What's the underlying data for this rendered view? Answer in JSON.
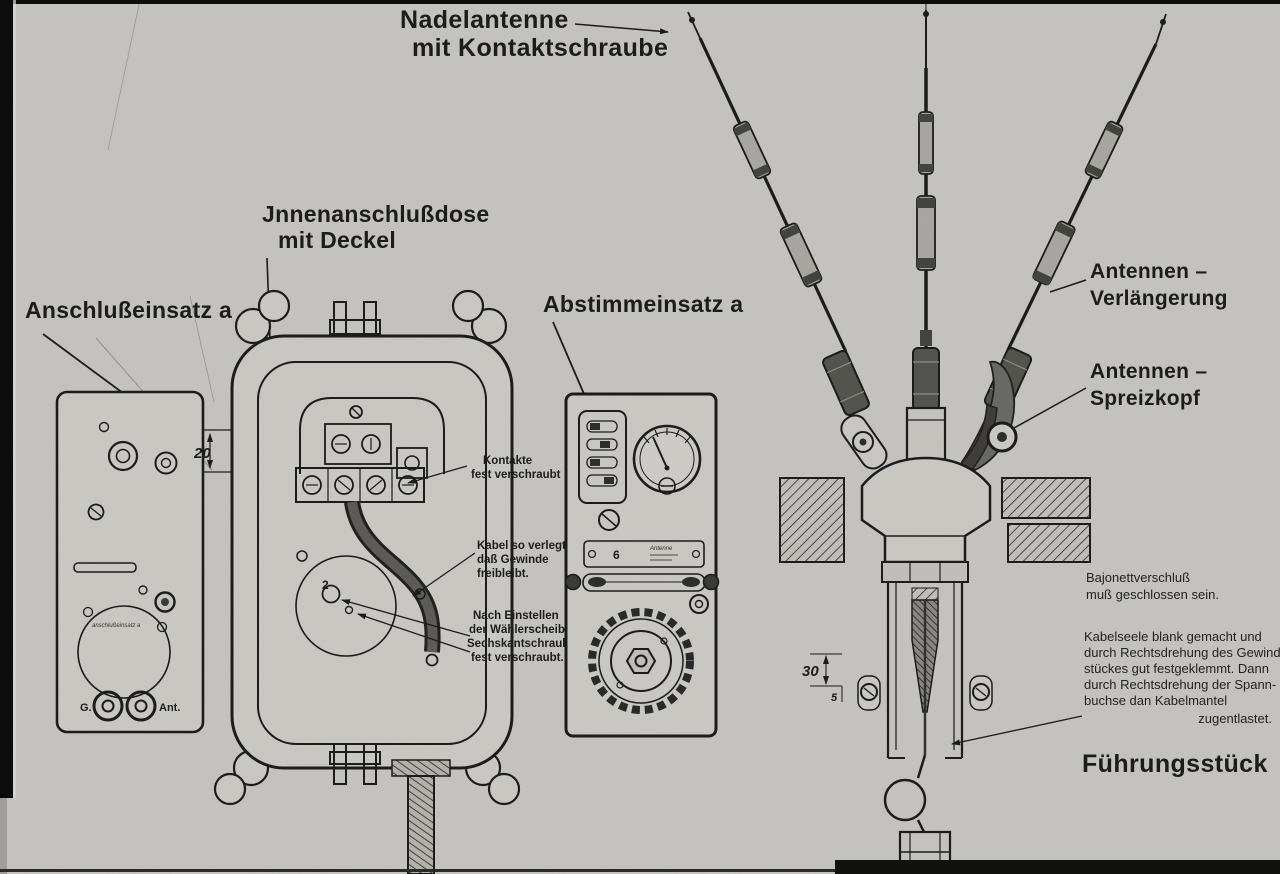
{
  "colors": {
    "paper": "#c6c5c1",
    "panel": "#cbcac5",
    "ink": "#1b1b1a",
    "dark_metal": "#55544f"
  },
  "callouts": {
    "nadelantenne": {
      "line1": "Nadelantenne",
      "line2": "mit Kontaktschraube"
    },
    "anschlusseinsatz": {
      "label": "Anschlußeinsatz a"
    },
    "innenanschlussdose": {
      "line1": "Jnnenanschlußdose",
      "line2": "mit Deckel"
    },
    "abstimmeinsatz": {
      "label": "Abstimmeinsatz a"
    },
    "antennen_verlaengerung": {
      "line1": "Antennen –",
      "line2": "Verlängerung"
    },
    "antennen_spreizkopf": {
      "line1": "Antennen –",
      "line2": "Spreizkopf"
    },
    "fuehrungsstueck": {
      "label": "Führungsstück"
    }
  },
  "annotations": {
    "kontakte": [
      "Kontakte",
      "fest verschraubt"
    ],
    "kabel": [
      "Kabel so verlegt,",
      "daß Gewinde",
      "freibleibt."
    ],
    "waehlerscheibe": [
      "Nach Einstellen",
      "der Wählerscheibe",
      "Sechskantschraube",
      "fest verschraubt."
    ],
    "bajonett": [
      "Bajonettverschluß",
      "muß geschlossen sein."
    ],
    "kabelseele": [
      "Kabelseele blank gemacht und",
      "durch Rechtsdrehung des Gewinde-",
      "stückes gut festgeklemmt. Dann",
      "durch Rechtsdrehung der Spann-",
      "buchse dan Kabelmantel",
      "zugentlastet."
    ]
  },
  "dimensions": {
    "cover_depth": "20",
    "wall_depth": "30",
    "offset": "5"
  },
  "connector_panel": {
    "left_socket": "G.",
    "right_socket": "Ant.",
    "dial_caption": "anschlußeinsatz a"
  },
  "tuning_panel": {
    "plate_number": "6",
    "plate_caption": "Antenne"
  },
  "markers": {
    "dial_number": "2"
  }
}
